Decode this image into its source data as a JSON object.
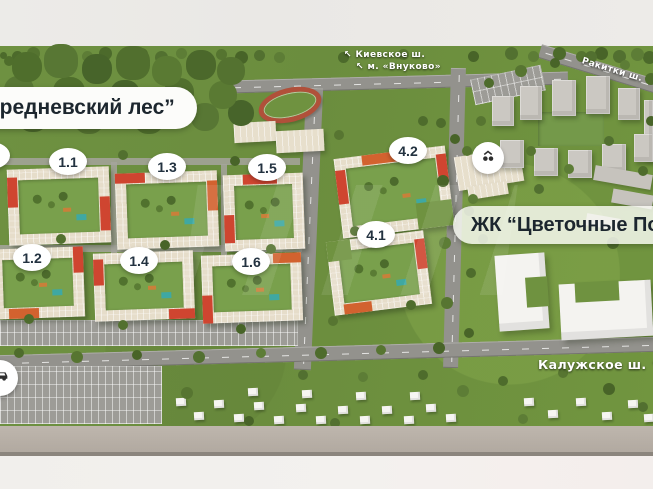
{
  "map": {
    "forest_label": "ередневский лес”",
    "complex_label": "ЖК “Цветочные По"
  },
  "road_labels": {
    "kievskoe": {
      "arrow": "↖",
      "text": "Киевское ш."
    },
    "metro": {
      "arrow": "↖",
      "text": "м. «Внуково»"
    },
    "rakitki": {
      "text": "Ракитки ш."
    },
    "kaluzhskoe": {
      "text": "Калужское ш.",
      "arrow": "↘"
    }
  },
  "badges": [
    {
      "label": "1.1"
    },
    {
      "label": "1.2"
    },
    {
      "label": "1.3"
    },
    {
      "label": "1.4"
    },
    {
      "label": "1.5"
    },
    {
      "label": "1.6"
    },
    {
      "label": "4.1"
    },
    {
      "label": "4.2"
    }
  ],
  "icons": {
    "landmark": "building-landmark-icon",
    "car": "car-icon"
  },
  "colors": {
    "building_red": "#cf4530",
    "building_orange": "#d2622f",
    "terrain_green": "#6e9141",
    "road_gray": "#93928d",
    "badge_text": "#233240"
  }
}
